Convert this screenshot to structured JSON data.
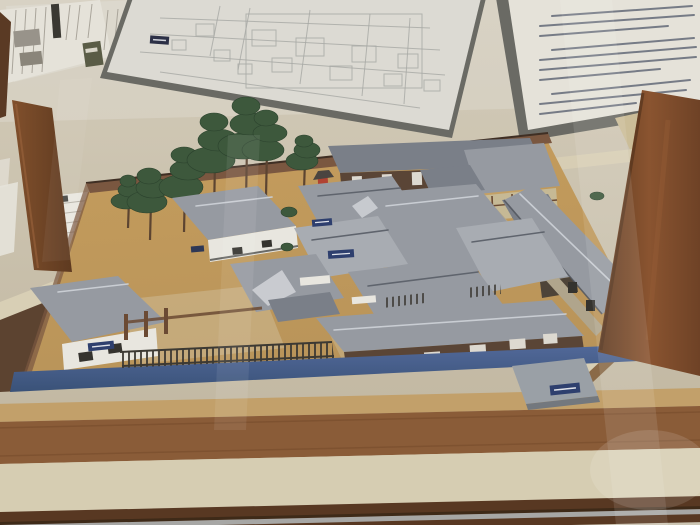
{
  "scene": {
    "type": "photograph",
    "subject": "Architectural scale model of a historical Japanese administrative compound displayed in a glass museum case",
    "view": "oblique view from front-left, slightly above",
    "legible_text": "none (all Japanese text on panels and labels is too small/blurred to read)"
  },
  "wall_items": {
    "newspaper_clipping": {
      "kind": "newspaper article with vertical Japanese columns",
      "photo_count": 2,
      "legibility": "illegible"
    },
    "floor_plan": {
      "kind": "large architectural floor-plan drawing on dark mount board",
      "legibility": "illegible"
    },
    "info_panel": {
      "kind": "explanatory text panel on dark mount board",
      "paragraph_count": 3,
      "legibility": "illegible"
    },
    "shelf_document": {
      "kind": "white printed sheet lying on shelf",
      "legibility": "illegible"
    }
  },
  "display_case": {
    "frame": "dark brown wooden posts, left and right",
    "glass": "front glass with diagonal reflections",
    "base": "stepped wooden platform with metal rail at bottom"
  },
  "model": {
    "ground": "ochre earth courtyard with lighter gravel yards",
    "moat": "blue painted water channel along the front edge",
    "perimeter": "brown board fence at rear, iron-bar fence at front",
    "buildings": [
      {
        "name": "corner gatehouse",
        "walls": "white",
        "label": "navy name plate"
      },
      {
        "name": "storehouse",
        "walls": "white",
        "label": "dark name plate"
      },
      {
        "name": "main hall complex",
        "roofs": "grey tiled, hip-and-gable"
      },
      {
        "name": "north barracks",
        "walls": "dark with white doors"
      },
      {
        "name": "northeast gabled house",
        "walls": "half-timbered beige"
      },
      {
        "name": "east row house",
        "roof": "long grey"
      },
      {
        "name": "south row house",
        "walls": "dark with white panels"
      },
      {
        "name": "front gate bridge",
        "label": "navy name plate"
      }
    ],
    "garden": "cluster of green pine trees on the west side",
    "shrine": "tiny red shrine at the north wall",
    "ground_labels": 2
  },
  "colors": {
    "wall-top": "#d8d2c4",
    "wall-bot": "#cdc6b4",
    "shelf": "#c7bda8",
    "paper": "#e5e2d9",
    "paper-dim": "#dbd7cc",
    "board": "#6a6a64",
    "bp-line": "#a6a8a4",
    "panel-text": "#5a6270",
    "news-line": "#a9a49a",
    "photo-gray": "#98938a",
    "headline-dark": "#3a3832",
    "olive": "#5a5c46",
    "ground": "#bf9a5e",
    "ground-light": "#cfb27c",
    "gravel": "#ccb88f",
    "moat": "#46618c",
    "moat-dark": "#3a5278",
    "roof-gray": "#969aa1",
    "roof-light": "#a8acb2",
    "roof-dark": "#7a7f88",
    "ridge": "#5f646d",
    "wall-white": "#e8e6df",
    "wall-dark": "#5a4536",
    "timber-beige": "#c6b995",
    "fence-brown": "#6b4a33",
    "fence-iron": "#3c3933",
    "tree-green": "#3d583c",
    "trunk": "#5c4431",
    "shrine-red": "#b04232",
    "label-navy": "#2e3f6e",
    "cream": "#d8cfb5",
    "platform-edge": "#86755a",
    "wedge-dark": "#5c4330",
    "post-light": "#8a5430",
    "post-dark": "#5e3a20",
    "base-tan": "#c2a06a",
    "base-brown": "#8a5c38",
    "base-cream": "#d6cdb2",
    "base-dark": "#583822",
    "rail": "#a7a7a5"
  }
}
